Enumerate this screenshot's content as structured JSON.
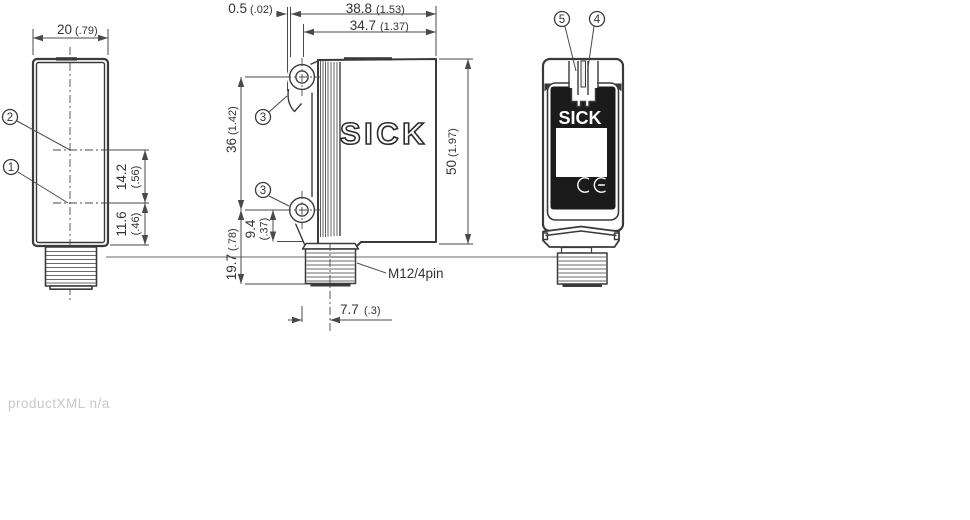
{
  "drawing": {
    "brand_logo": "SICK",
    "front_logo": "SICK",
    "footer_note": "productXML n/a",
    "connector_label": "M12/4pin",
    "callouts": {
      "one": "1",
      "two": "2",
      "three_top": "3",
      "three_bottom": "3",
      "four": "4",
      "five": "5"
    },
    "dims": {
      "front_width_mm": "20",
      "front_width_in": "(.79)",
      "face_offset_mm": "0.5",
      "face_offset_in": "(.02)",
      "depth_total_mm": "38.8",
      "depth_total_in": "(1.53)",
      "depth_body_mm": "34.7",
      "depth_body_in": "(1.37)",
      "hole_span_mm": "36",
      "hole_span_in": "(1.42)",
      "height_mm": "50",
      "height_in": "(1.97)",
      "axis_upper_mm": "14.2",
      "axis_upper_in": "(.56)",
      "axis_lower_mm": "11.6",
      "axis_lower_in": "(.46)",
      "hole_to_tip_mm": "19.7",
      "hole_to_tip_in": "(.78)",
      "hole_to_base_mm": "9.4",
      "hole_to_base_in": "(.37)",
      "connector_offset_mm": "7.7",
      "connector_offset_in": "(.3)"
    }
  },
  "colors": {
    "line": "#3a3a3a",
    "panel": "#1b1b1b",
    "text": "#333333",
    "muted": "#c9c9c9"
  }
}
